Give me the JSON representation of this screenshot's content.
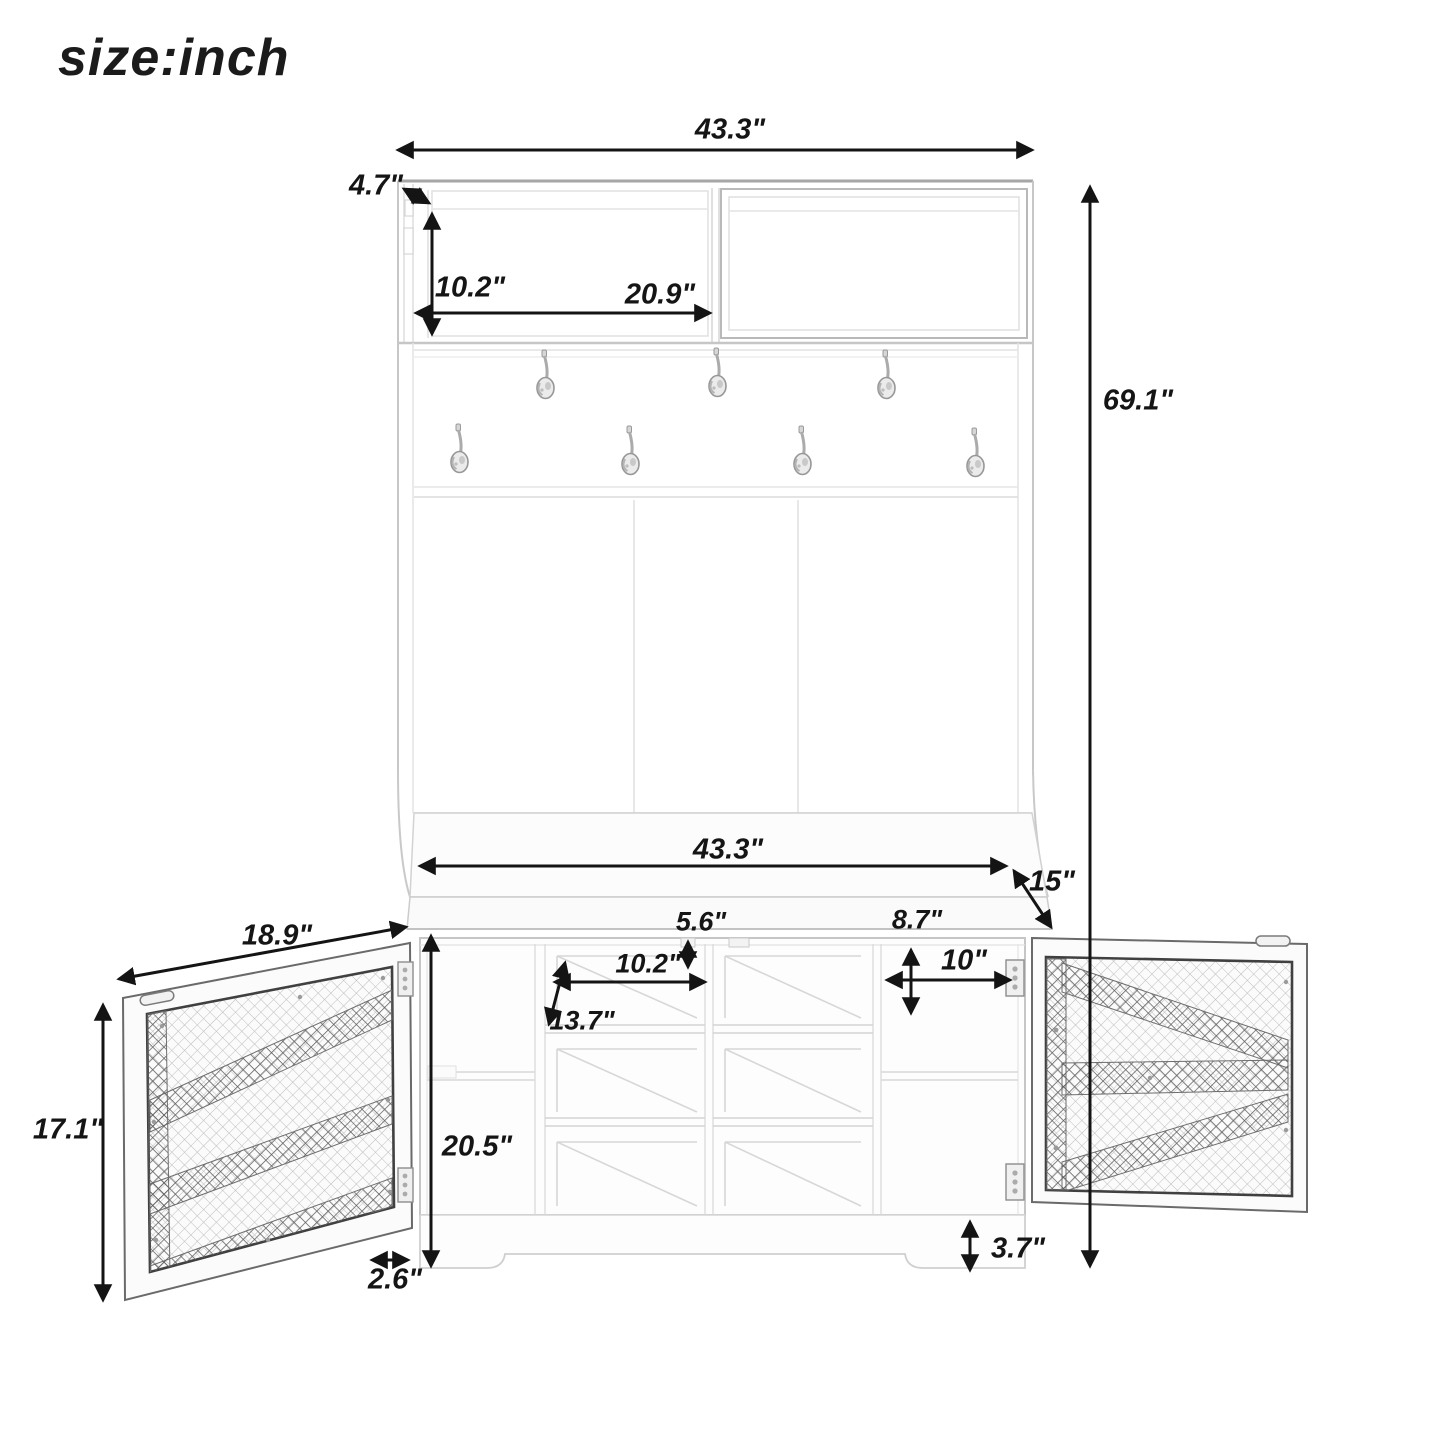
{
  "title": "size:inch",
  "dims": {
    "top_width": "43.3\"",
    "top_depth": "4.7\"",
    "upper_cubby_height": "10.2\"",
    "upper_cubby_width": "20.9\"",
    "overall_height": "69.1\"",
    "bench_width": "43.3\"",
    "bench_depth": "15\"",
    "left_door_width": "18.9\"",
    "seat_front_height": "5.6\"",
    "right_cubby_height": "8.7\"",
    "right_cubby_width": "10\"",
    "shoe_cubby_width": "10.2\"",
    "shoe_shelf_depth": "13.7\"",
    "left_door_height": "17.1\"",
    "lower_cabinet_height": "20.5\"",
    "foot_width": "2.6\"",
    "base_height": "3.7\""
  }
}
